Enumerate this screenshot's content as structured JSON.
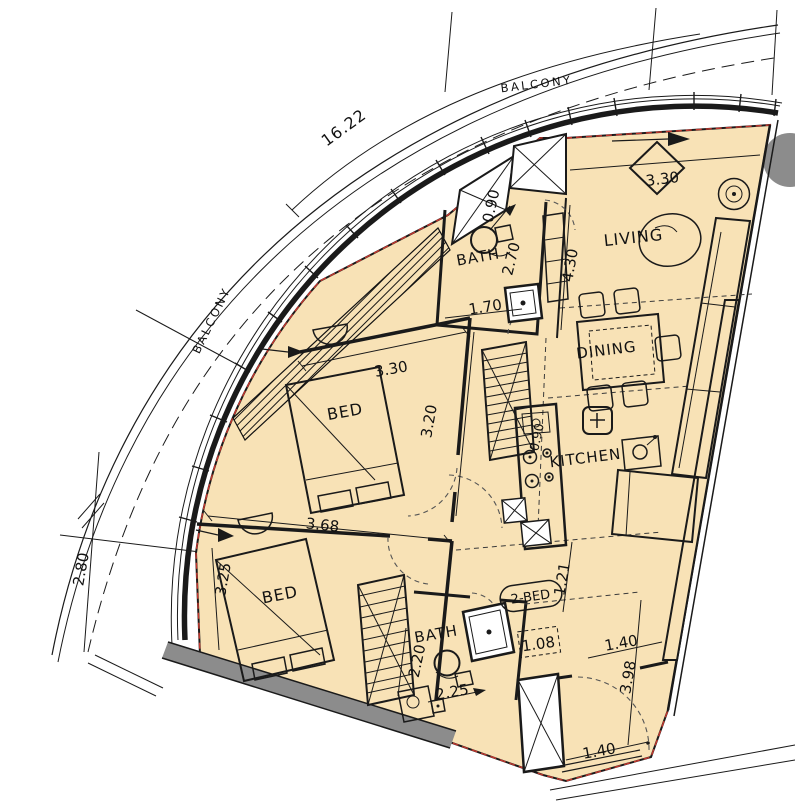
{
  "colors": {
    "floor": "#f8e2b6",
    "outline": "#c4372e",
    "wall": "#1a1a1a",
    "gray": "#8c8c8c"
  },
  "rooms": {
    "balcony_top": "BALCONY",
    "balcony_left": "BALCONY",
    "living": "LIVING",
    "dining": "DINING",
    "kitchen": "KITCHEN",
    "bath_top": "BATH",
    "bath_bottom": "BATH",
    "bed_upper": "BED",
    "bed_lower": "BED",
    "unit_tag": "2-BED"
  },
  "dims": {
    "arc_length": "16.22",
    "entry_width": "0.90",
    "entry_depth": "2.70",
    "hall_width": "1.70",
    "living_width": "3.30",
    "living_depth": "4.30",
    "bed1_width": "3.30",
    "bed1_depth": "3.20",
    "bed2_width": "3.68",
    "bed2_depth": "3.25",
    "balcony_width": "2.80",
    "kitchen_counter": "0.90",
    "corridor_width": "1.21",
    "lobby_width": "1.08",
    "store_width": "1.40",
    "store_depth": "3.98",
    "bath2_depth": "2.20",
    "bath2_width": "2.25",
    "shaft_width": "1.40"
  }
}
